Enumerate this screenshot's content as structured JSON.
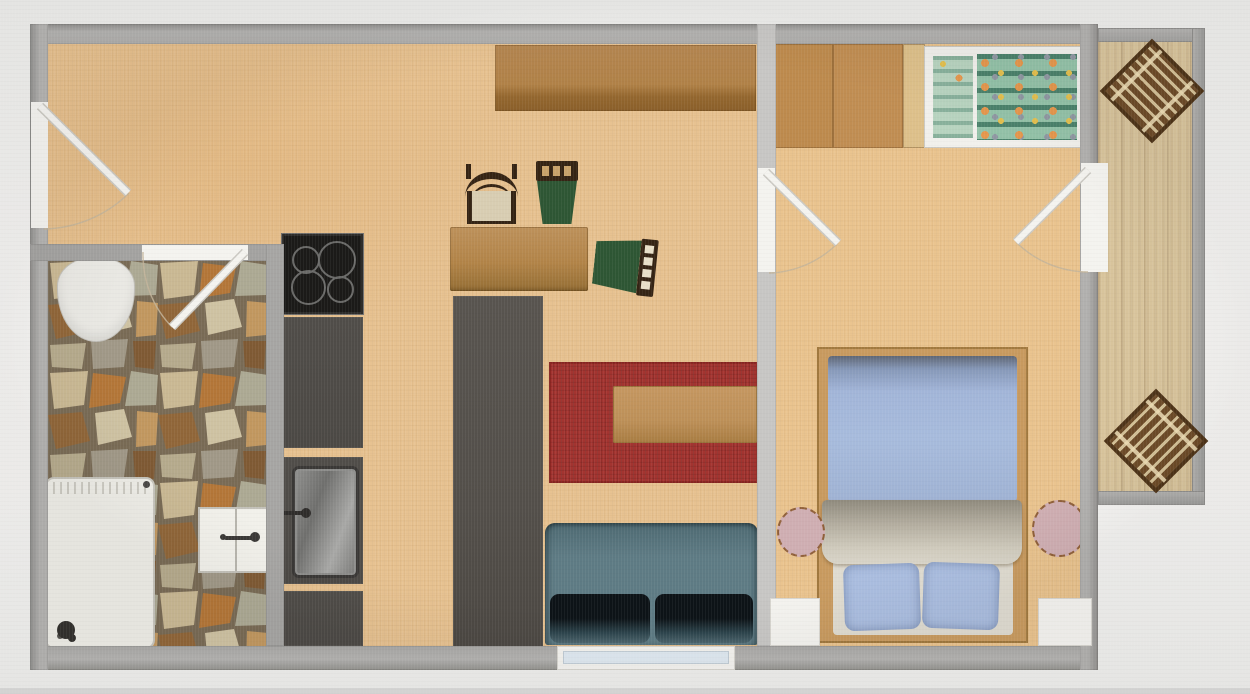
{
  "scene": {
    "description": "Top-down 2D floor plan of a one-bedroom apartment with balcony, no text labels visible",
    "view": "2D floor plan render (photo of a screen)"
  },
  "colors": {
    "background": "#f0efed",
    "wall": "#a8a7a5",
    "wall-light": "#c7c6c4",
    "floor": "#e7c291",
    "floor-bedroom": "#eac48f",
    "balcony-floor": "#d8c49c",
    "grout": "#70624f",
    "counter": "#4c4945",
    "island": "#534f4a",
    "cooktop": "#1b1a18",
    "rug": "#a33430",
    "table-wood": "#b28448",
    "coffee-wood": "#bd9058",
    "sideboard-top": "#b08147",
    "sideboard-bottom": "#94672f",
    "sofa": "#5e7b84",
    "cushion-dark": "#0d1317",
    "bed-frame": "#c89a5f",
    "duvet": "#a7bbdc",
    "pillow": "#aabddf",
    "blanket": "#cfcabc",
    "sheet": "#dfdbd0",
    "nightstand": "#cfaeb2",
    "wardrobe": "#c08d52",
    "wardrobe-side": "#ddc08a",
    "crib-frame": "#f1f0ec",
    "crib-bedding": "#93c2a8",
    "dot-orange": "#e5974d",
    "dot-yellow": "#e3c04f",
    "chair-wood": "#352414",
    "chair-green": "#2e5634",
    "chair-beige": "#d8cdb2",
    "deck-slat": "#6d4b28",
    "deck-frame": "#4e3418",
    "fixture-white": "#f1f0ea",
    "window-glass": "#dfe9f1",
    "door-leaf": "#f4f3ef"
  },
  "rooms": [
    {
      "name": "entry-living-kitchen",
      "floor": "light wood"
    },
    {
      "name": "bathroom",
      "floor": "natural stone tiles"
    },
    {
      "name": "bedroom",
      "floor": "light wood"
    },
    {
      "name": "balcony",
      "floor": "wood plank decking"
    }
  ],
  "doors": [
    {
      "name": "entry-door",
      "wall": "left exterior wall",
      "swing": "into entry"
    },
    {
      "name": "bathroom-door",
      "wall": "bathroom top wall",
      "swing": "into bathroom"
    },
    {
      "name": "bedroom-door",
      "wall": "living/bedroom divider",
      "swing": "into bedroom"
    },
    {
      "name": "balcony-door",
      "wall": "bedroom right wall",
      "swing": "into bedroom"
    }
  ],
  "windows": [
    {
      "name": "living-window",
      "wall": "bottom wall under sofa"
    },
    {
      "name": "bedroom-window-left",
      "wall": "bedroom bottom wall"
    },
    {
      "name": "bedroom-window-right",
      "wall": "bedroom bottom wall"
    }
  ],
  "furniture": [
    {
      "name": "toilet",
      "room": "bathroom"
    },
    {
      "name": "shower-with-radiator",
      "room": "bathroom"
    },
    {
      "name": "washbasin",
      "room": "bathroom"
    },
    {
      "name": "cooktop-4-burners",
      "room": "kitchen"
    },
    {
      "name": "counter-upper",
      "room": "kitchen"
    },
    {
      "name": "sink-unit",
      "room": "kitchen"
    },
    {
      "name": "counter-lower",
      "room": "kitchen"
    },
    {
      "name": "island-counter",
      "room": "kitchen"
    },
    {
      "name": "dining-table",
      "room": "living"
    },
    {
      "name": "chair-beige-upholstered",
      "room": "living"
    },
    {
      "name": "chair-green-1",
      "room": "living"
    },
    {
      "name": "chair-green-2",
      "room": "living"
    },
    {
      "name": "sideboard",
      "room": "living"
    },
    {
      "name": "red-rug",
      "room": "living"
    },
    {
      "name": "coffee-table",
      "room": "living"
    },
    {
      "name": "sofa-teal-two-seats",
      "room": "living"
    },
    {
      "name": "wardrobe",
      "room": "bedroom"
    },
    {
      "name": "crib-patterned-bedding",
      "room": "bedroom"
    },
    {
      "name": "double-bed-blue-duvet",
      "room": "bedroom"
    },
    {
      "name": "nightstand-round-left",
      "room": "bedroom"
    },
    {
      "name": "nightstand-round-right",
      "room": "bedroom"
    },
    {
      "name": "deck-chair-top",
      "room": "balcony"
    },
    {
      "name": "deck-chair-bottom",
      "room": "balcony"
    }
  ]
}
